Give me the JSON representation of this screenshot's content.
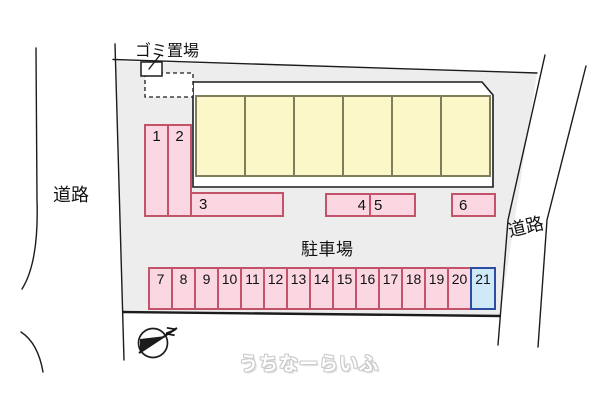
{
  "labels": {
    "garbage_area": "ゴミ置場",
    "parking_area": "駐車場",
    "road_left": "道路",
    "road_right": "道路",
    "compass_north": "N",
    "watermark": "うちなーらいふ"
  },
  "colors": {
    "parcel_fill": "#ededed",
    "line_color": "#1c1c1c",
    "stall_pink_fill": "#fbd7e1",
    "stall_pink_border": "#c3536b",
    "stall_blue_fill": "#d0e9f9",
    "stall_blue_border": "#2d4da0",
    "building_fill": "#fbf7c8",
    "building_border": "#7e7e5a"
  },
  "building": {
    "units": 6
  },
  "parking": {
    "stalls": [
      {
        "label": "1",
        "type": "pink"
      },
      {
        "label": "2",
        "type": "pink"
      },
      {
        "label": "3",
        "type": "pink"
      },
      {
        "label": "4",
        "type": "pink"
      },
      {
        "label": "5",
        "type": "pink"
      },
      {
        "label": "6",
        "type": "pink"
      },
      {
        "label": "7",
        "type": "pink"
      },
      {
        "label": "8",
        "type": "pink"
      },
      {
        "label": "9",
        "type": "pink"
      },
      {
        "label": "10",
        "type": "pink"
      },
      {
        "label": "11",
        "type": "pink"
      },
      {
        "label": "12",
        "type": "pink"
      },
      {
        "label": "13",
        "type": "pink"
      },
      {
        "label": "14",
        "type": "pink"
      },
      {
        "label": "15",
        "type": "pink"
      },
      {
        "label": "16",
        "type": "pink"
      },
      {
        "label": "17",
        "type": "pink"
      },
      {
        "label": "18",
        "type": "pink"
      },
      {
        "label": "19",
        "type": "pink"
      },
      {
        "label": "20",
        "type": "pink"
      },
      {
        "label": "21",
        "type": "blue"
      }
    ]
  }
}
